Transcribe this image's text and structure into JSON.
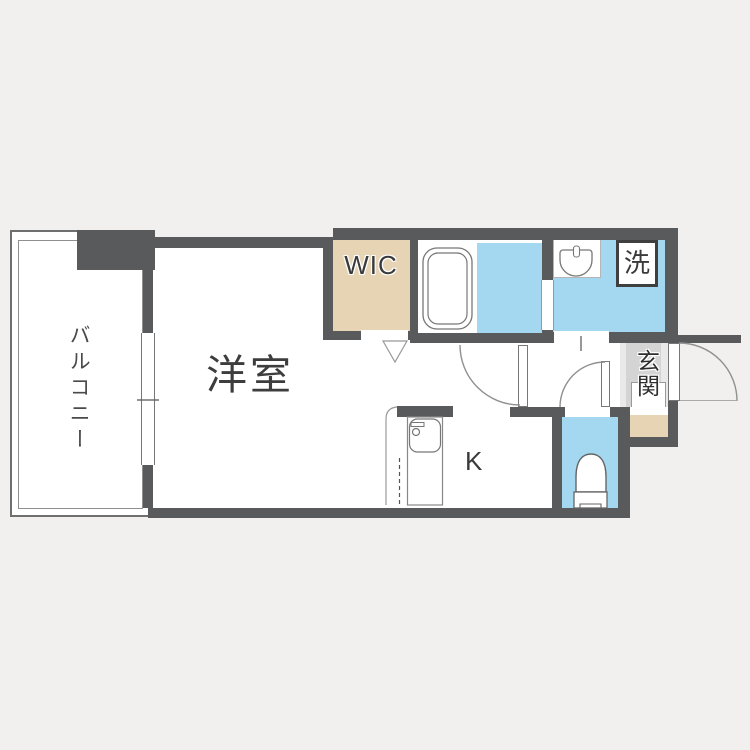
{
  "meta": {
    "type": "apartment-floor-plan"
  },
  "colors": {
    "background": "#f1f0ee",
    "wall": "#595a5c",
    "wet_area_floor": "#a3d8f0",
    "closet_floor": "#e6d4b4",
    "entry_floor": "#d4d4d4",
    "outline": "#7a7a7a",
    "text": "#3d3d3d"
  },
  "rooms": {
    "balcony": {
      "label": "バルコニー"
    },
    "main_room": {
      "label": "洋室"
    },
    "wic": {
      "label": "WIC"
    },
    "kitchen": {
      "label": "K"
    },
    "laundry": {
      "label": "洗"
    },
    "entrance": {
      "label": "玄関"
    }
  },
  "fixtures": {
    "bathtub": "bathtub",
    "wash_basin": "wash-basin",
    "toilet": "toilet",
    "kitchen_sink": "kitchen-sink",
    "washing_machine_slot": "washing-machine"
  }
}
